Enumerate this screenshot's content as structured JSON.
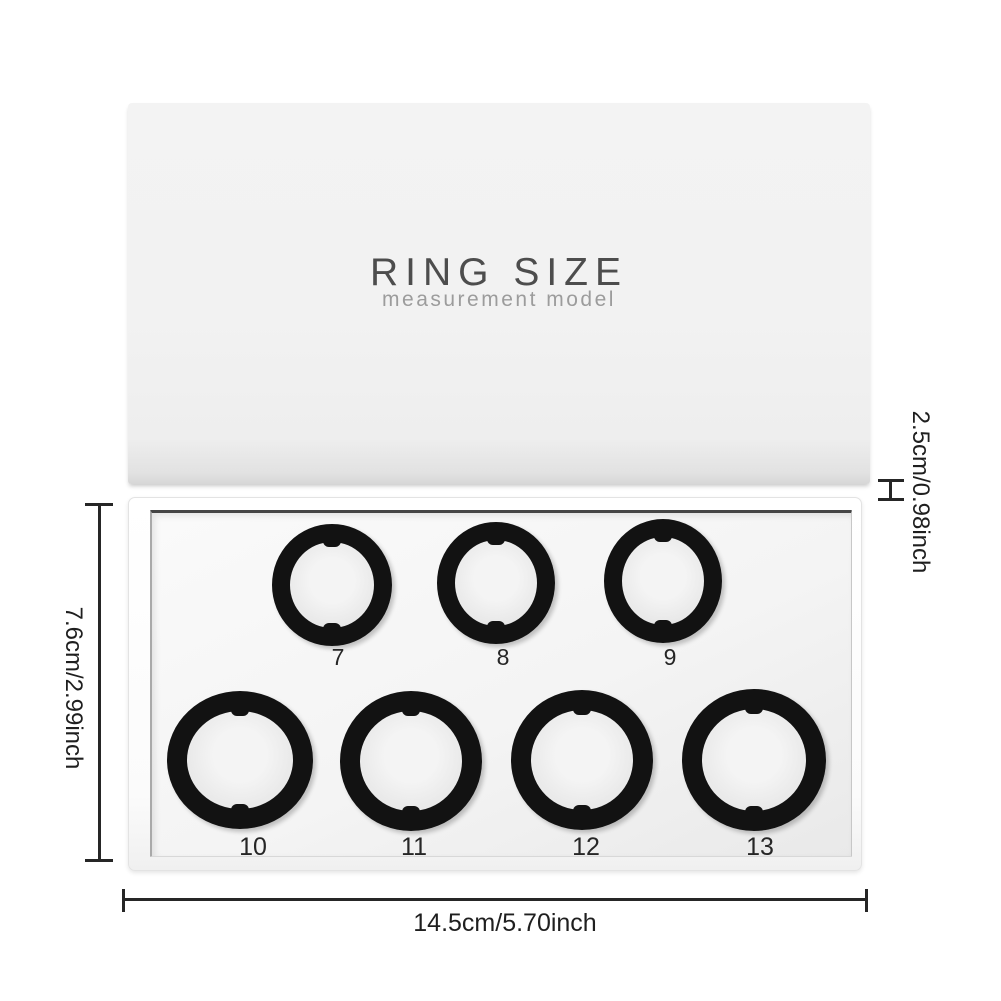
{
  "product": {
    "lid": {
      "title": "RING SIZE",
      "subtitle": "measurement model"
    },
    "rings": [
      {
        "size": "7"
      },
      {
        "size": "8"
      },
      {
        "size": "9"
      },
      {
        "size": "10"
      },
      {
        "size": "11"
      },
      {
        "size": "12"
      },
      {
        "size": "13"
      }
    ]
  },
  "dimensions": {
    "box_height": "7.6cm/2.99inch",
    "box_width": "14.5cm/5.70inch",
    "lid_height": "2.5cm/0.98inch"
  },
  "colors": {
    "background": "#ffffff",
    "lid_surface": "#f2f2f2",
    "tray_surface": "#f4f4f4",
    "ring": "#121212",
    "title_text": "#4d4d4d",
    "subtitle_text": "#9c9c9c",
    "dimension_ink": "#262626"
  }
}
